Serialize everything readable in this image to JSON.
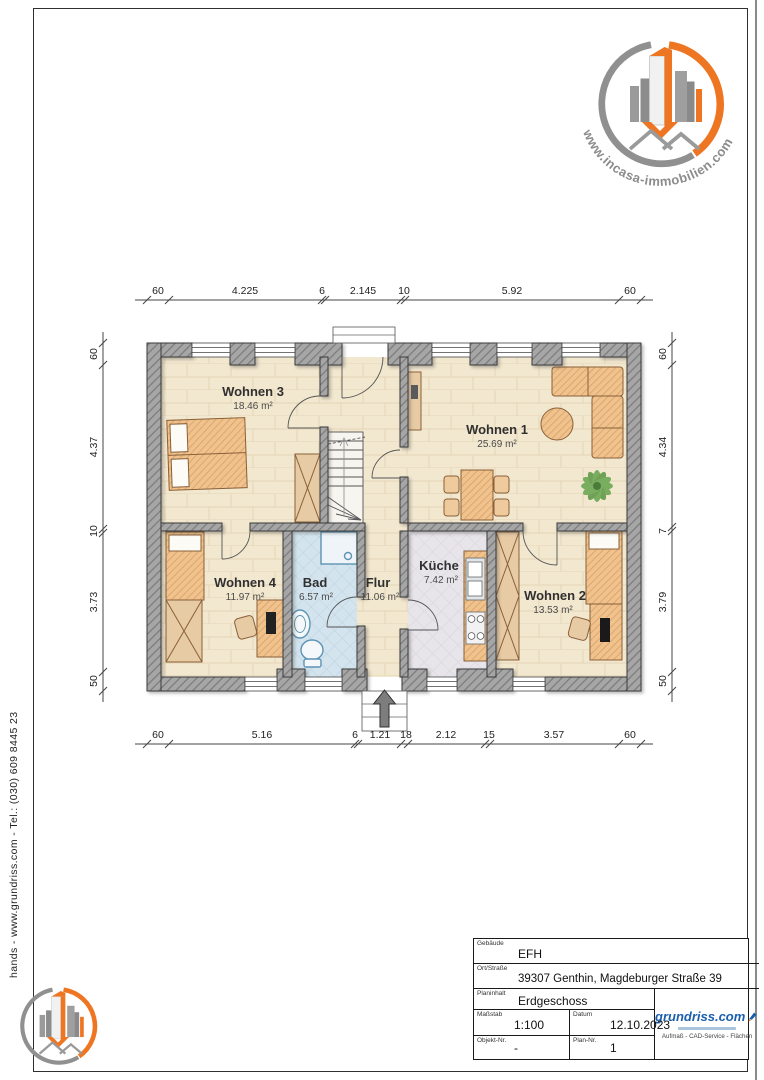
{
  "page": {
    "sidebar_text": "hands  -  www.grundriss.com  -  Tel.: (030) 609 8445 23"
  },
  "branding": {
    "incasa_url": "www.incasa-immobilien.com",
    "grundriss_name": "grundriss.com",
    "grundriss_tagline": "Aufmaß - CAD-Service - Flächen"
  },
  "plan": {
    "rooms": {
      "w1": {
        "name": "Wohnen 1",
        "area": "25.69 m²"
      },
      "w2": {
        "name": "Wohnen 2",
        "area": "13.53 m²"
      },
      "w3": {
        "name": "Wohnen 3",
        "area": "18.46 m²"
      },
      "w4": {
        "name": "Wohnen 4",
        "area": "11.97 m²"
      },
      "bad": {
        "name": "Bad",
        "area": "6.57 m²"
      },
      "flur": {
        "name": "Flur",
        "area": "11.06 m²"
      },
      "kueche": {
        "name": "Küche",
        "area": "7.42 m²"
      }
    },
    "dims": {
      "top": [
        "60",
        "4.225",
        "6",
        "2.145",
        "10",
        "5.92",
        "60"
      ],
      "bottom": [
        "60",
        "5.16",
        "6",
        "1.21",
        "18",
        "2.12",
        "15",
        "3.57",
        "60"
      ],
      "left": [
        "60",
        "4.37",
        "10",
        "3.73",
        "50"
      ],
      "right": [
        "60",
        "4.34",
        "7",
        "3.79",
        "50"
      ]
    }
  },
  "title_block": {
    "gebaeude": {
      "label": "Gebäude",
      "value": "EFH"
    },
    "ort": {
      "label": "Ort/Straße",
      "value": "39307 Genthin, Magdeburger Straße 39"
    },
    "planinhalt": {
      "label": "Planinhalt",
      "value": "Erdgeschoss"
    },
    "massstab": {
      "label": "Maßstab",
      "value": "1:100"
    },
    "datum": {
      "label": "Datum",
      "value": "12.10.2023"
    },
    "objekt": {
      "label": "Objekt-Nr.",
      "value": "-"
    },
    "plan_nr": {
      "label": "Plan-Nr.",
      "value": "1"
    }
  },
  "colors": {
    "brand_orange": "#ee7623",
    "brand_gray": "#8f8f8f",
    "grundriss_blue": "#1a5fae",
    "wall_gray": "#a6a6a6",
    "floor_beige": "#f2e7cf",
    "bad_blue": "#d3e4ee",
    "kueche_gray": "#e7e5e9",
    "furniture_wood": "#efc28e"
  }
}
